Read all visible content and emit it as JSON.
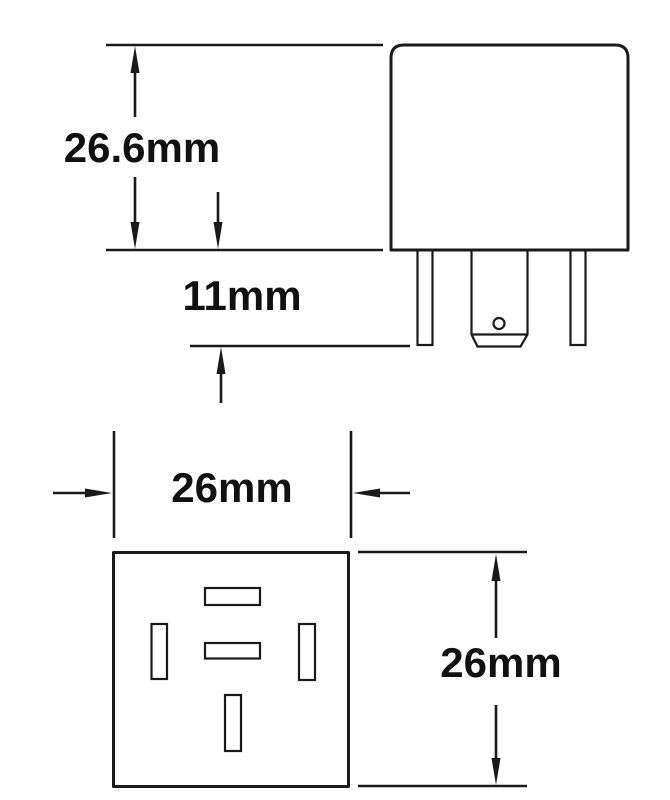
{
  "diagram": {
    "kind": "technical-dimension-drawing",
    "labels": {
      "body_height": "26.6mm",
      "pin_length": "11mm",
      "base_width": "26mm",
      "base_height": "26mm"
    },
    "colors": {
      "line": "#1a1a1a",
      "background": "#ffffff",
      "text": "#111111"
    }
  }
}
